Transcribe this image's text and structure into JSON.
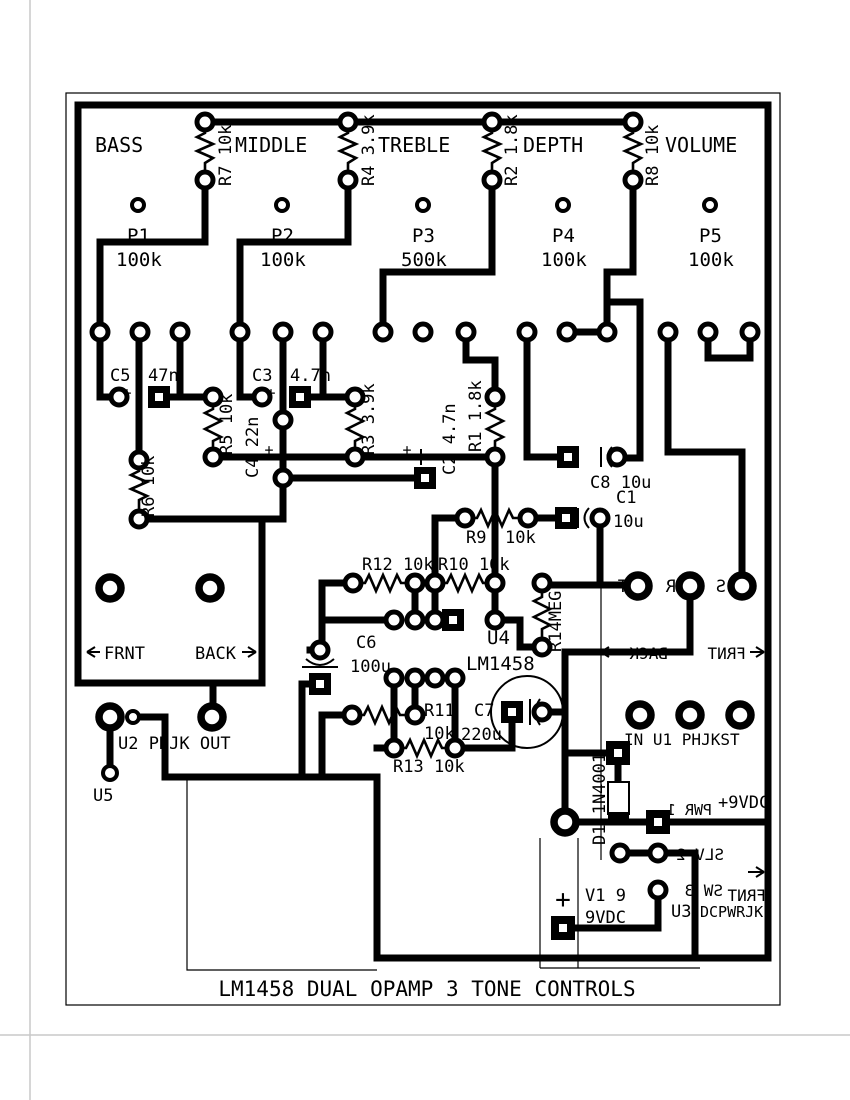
{
  "title": "LM1458 DUAL OPAMP 3 TONE CONTROLS",
  "sections": {
    "bass": "BASS",
    "middle": "MIDDLE",
    "treble": "TREBLE",
    "depth": "DEPTH",
    "volume": "VOLUME"
  },
  "pots": {
    "p1": {
      "ref": "P1",
      "val": "100k"
    },
    "p2": {
      "ref": "P2",
      "val": "100k"
    },
    "p3": {
      "ref": "P3",
      "val": "500k"
    },
    "p4": {
      "ref": "P4",
      "val": "100k"
    },
    "p5": {
      "ref": "P5",
      "val": "100k"
    }
  },
  "resistors": {
    "r7": "R7 10k",
    "r4": "R4 3.9k",
    "r2": "R2 1.8k",
    "r8": "R8 10k",
    "r5": "R5 10k",
    "r3": "R3 3.9k",
    "r1": "R1 1.8k",
    "r6": "R6 10k",
    "r9_ref": "R9",
    "r9_val": "10k",
    "r10": "R10 10k",
    "r11_ref": "R11",
    "r11_val": "10k",
    "r12": "R12 10k",
    "r13": "R13 10k",
    "r14": "R14MEG"
  },
  "caps": {
    "c5_ref": "C5",
    "c5_val": "47n",
    "c3_ref": "C3",
    "c3_val": "4.7n",
    "c4": "C4 22n",
    "c2": "C2 4.7n",
    "c8": "C8 10u",
    "c1_ref": "C1",
    "c1_val": "10u",
    "c6_ref": "C6",
    "c6_val": "100u",
    "c7_ref": "C7",
    "c7_val": "220u"
  },
  "diode": {
    "d1": "D1 1N4001"
  },
  "ics": {
    "u4_ref": "U4",
    "u4_val": "LM1458",
    "u1": "IN U1 PHJKST",
    "u2": "U2 PHJK OUT",
    "u3_ref": "U3",
    "u3_val": "DCPWRJK",
    "u5": "U5"
  },
  "power": {
    "vplus": "+9VDC",
    "pwr": "PWR 1",
    "slv": "SLV 2",
    "sw": "SW 3",
    "v1_line1": "V1 9",
    "v1_line2": "9VDC",
    "battery_plus": "+"
  },
  "silk": {
    "frnt_left": "FRNT",
    "back_left": "BACK",
    "back_mid": "BACK",
    "frnt_mid": "FRNT",
    "frnt_br": "FRNT",
    "jack_t": "T",
    "jack_r": "R",
    "jack_s": "S"
  },
  "marks": {
    "plus": "+"
  }
}
